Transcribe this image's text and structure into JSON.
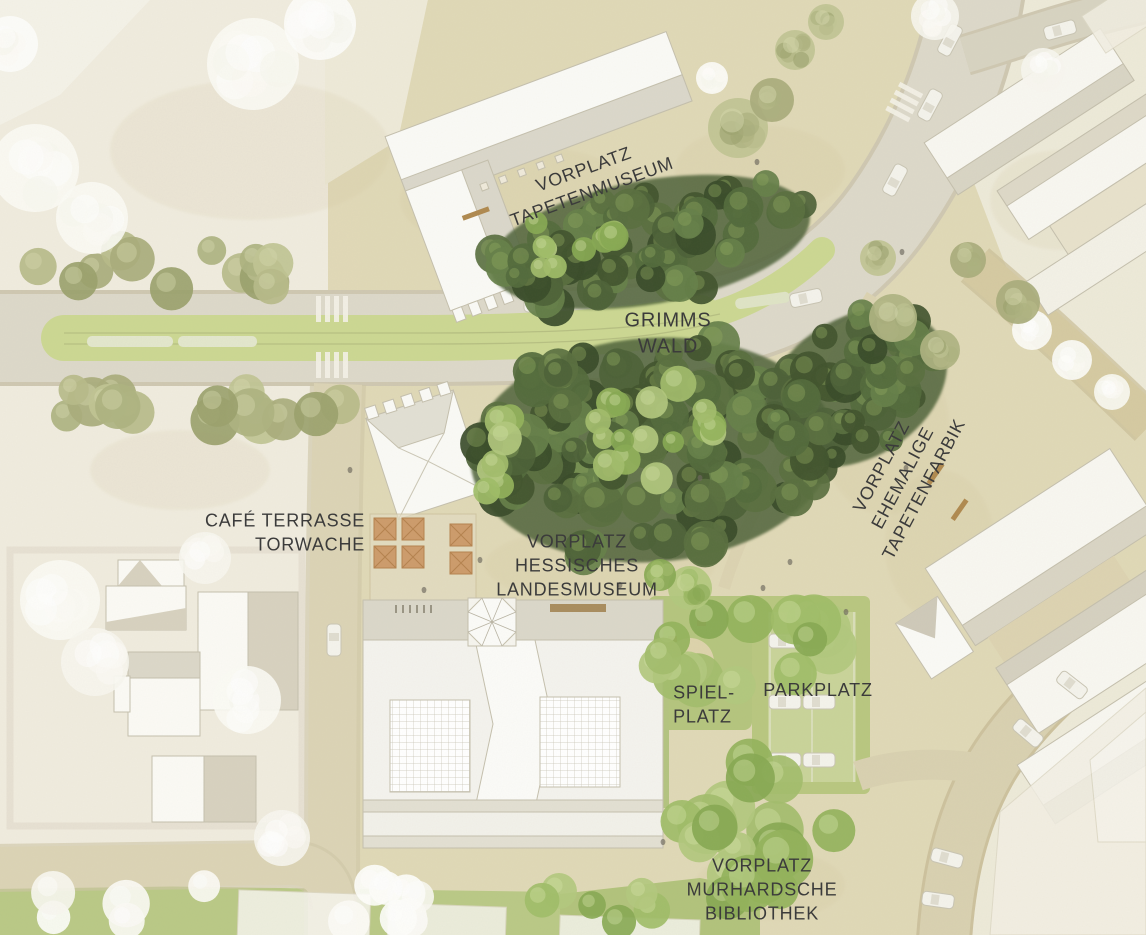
{
  "plan": {
    "type": "architectural-site-plan",
    "labels": [
      {
        "id": "vorplatz-tapetenmuseum",
        "text": "VORPLATZ\nTAPETENMUSEUM"
      },
      {
        "id": "grimms-wald",
        "text": "GRIMMS\nWALD"
      },
      {
        "id": "cafe-terrasse-torwache",
        "text": "CAFÉ TERRASSE\nTORWACHE"
      },
      {
        "id": "vorplatz-hessisches-landesmuseum",
        "text": "VORPLATZ\nHESSISCHES\nLANDESMUSEUM"
      },
      {
        "id": "spielplatz",
        "text": "SPIEL-\nPLATZ"
      },
      {
        "id": "parkplatz",
        "text": "PARKPLATZ"
      },
      {
        "id": "vorplatz-ehemalige-tapetenfarbik",
        "text": "VORPLATZ\nEHEMALIGE\nTAPETENFARBIK"
      },
      {
        "id": "vorplatz-murhardsche-bibliothek",
        "text": "VORPLATZ\nMURHARDSCHE\nBIBLIOTHEK"
      }
    ],
    "colors": {
      "ground": "#eeead9",
      "plaza_sand": "#ddd3ad",
      "road": "#dcd8c9",
      "grass_median": "#ccd893",
      "grass_park": "#b9c781",
      "tree_dark": "#4d6238",
      "tree_light": "#9fbd68",
      "tree_sage": "#aeb381",
      "tree_white": "#fbfaf5",
      "building_white": "#f8f7f1",
      "roof_shadow": "#d9d5c5",
      "umbrella": "#cd9c6c",
      "label_text": "#3b3b3b"
    }
  }
}
